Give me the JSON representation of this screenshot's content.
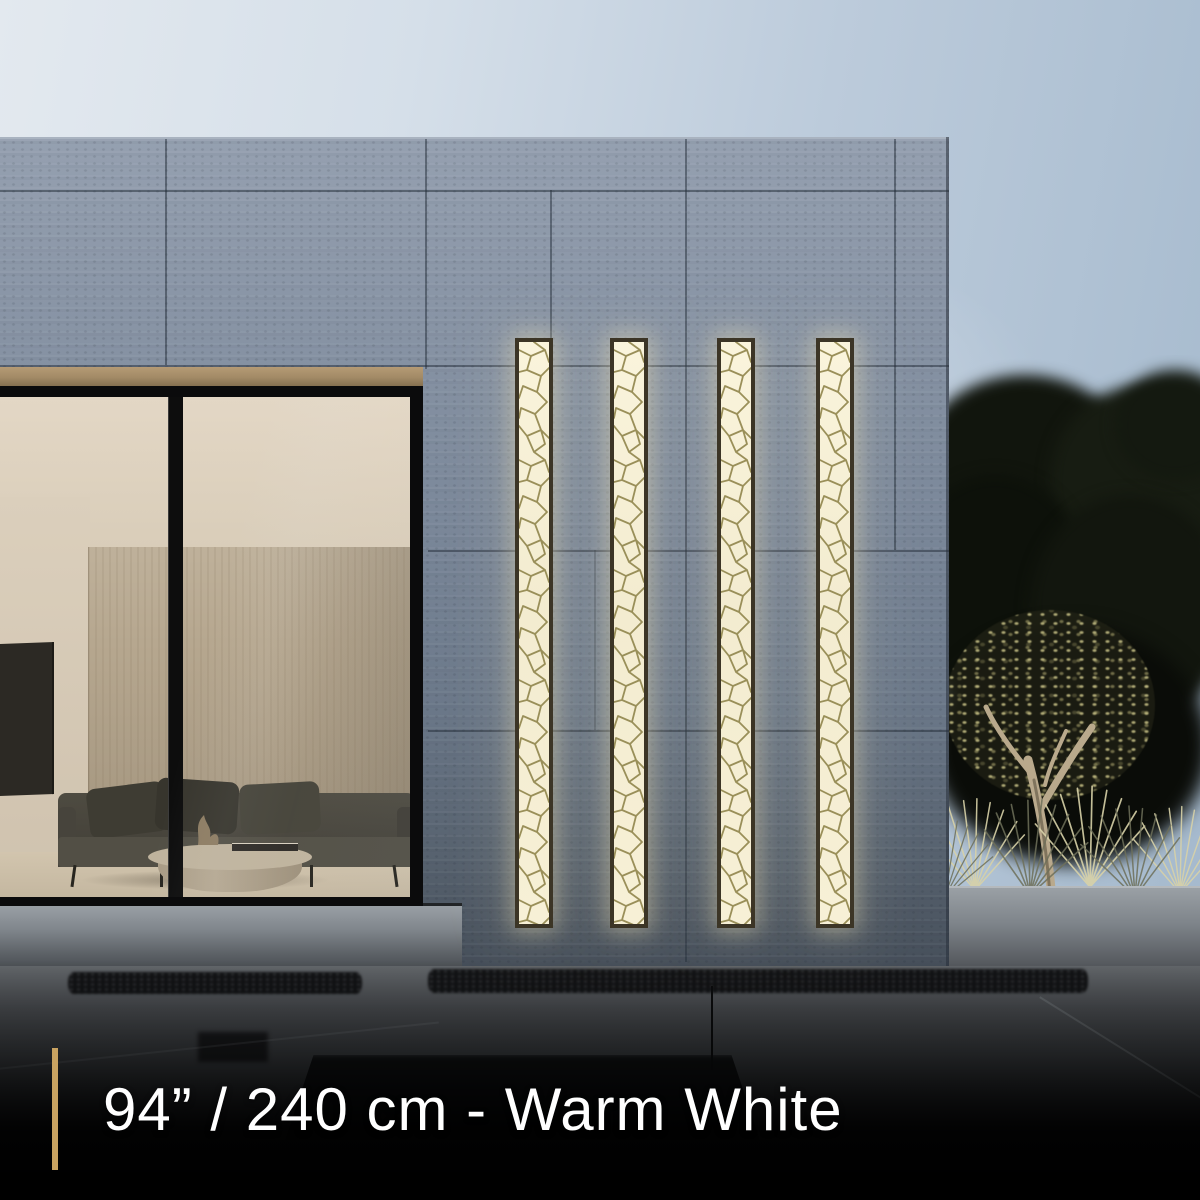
{
  "caption": {
    "text": "94” / 240 cm - Warm White",
    "accent_color": "#c9a361",
    "text_color": "#ffffff",
    "background_color": "#000000"
  },
  "scene": {
    "description": "Modern concrete house exterior at dusk with vertical warm-white LED mosaic wall lights, a glass wall showing a living room, and an uplit olive tree with grasses",
    "light_panel_count": 4,
    "panel_glow_color": "#f7f0d6",
    "panel_frame_color": "#3c3526",
    "panel_mosaic_line_color": "#948a52",
    "sky_color_right": "#a3b8cc",
    "sky_color_left": "#e3e9ef",
    "facade_color": "#7b889a"
  }
}
